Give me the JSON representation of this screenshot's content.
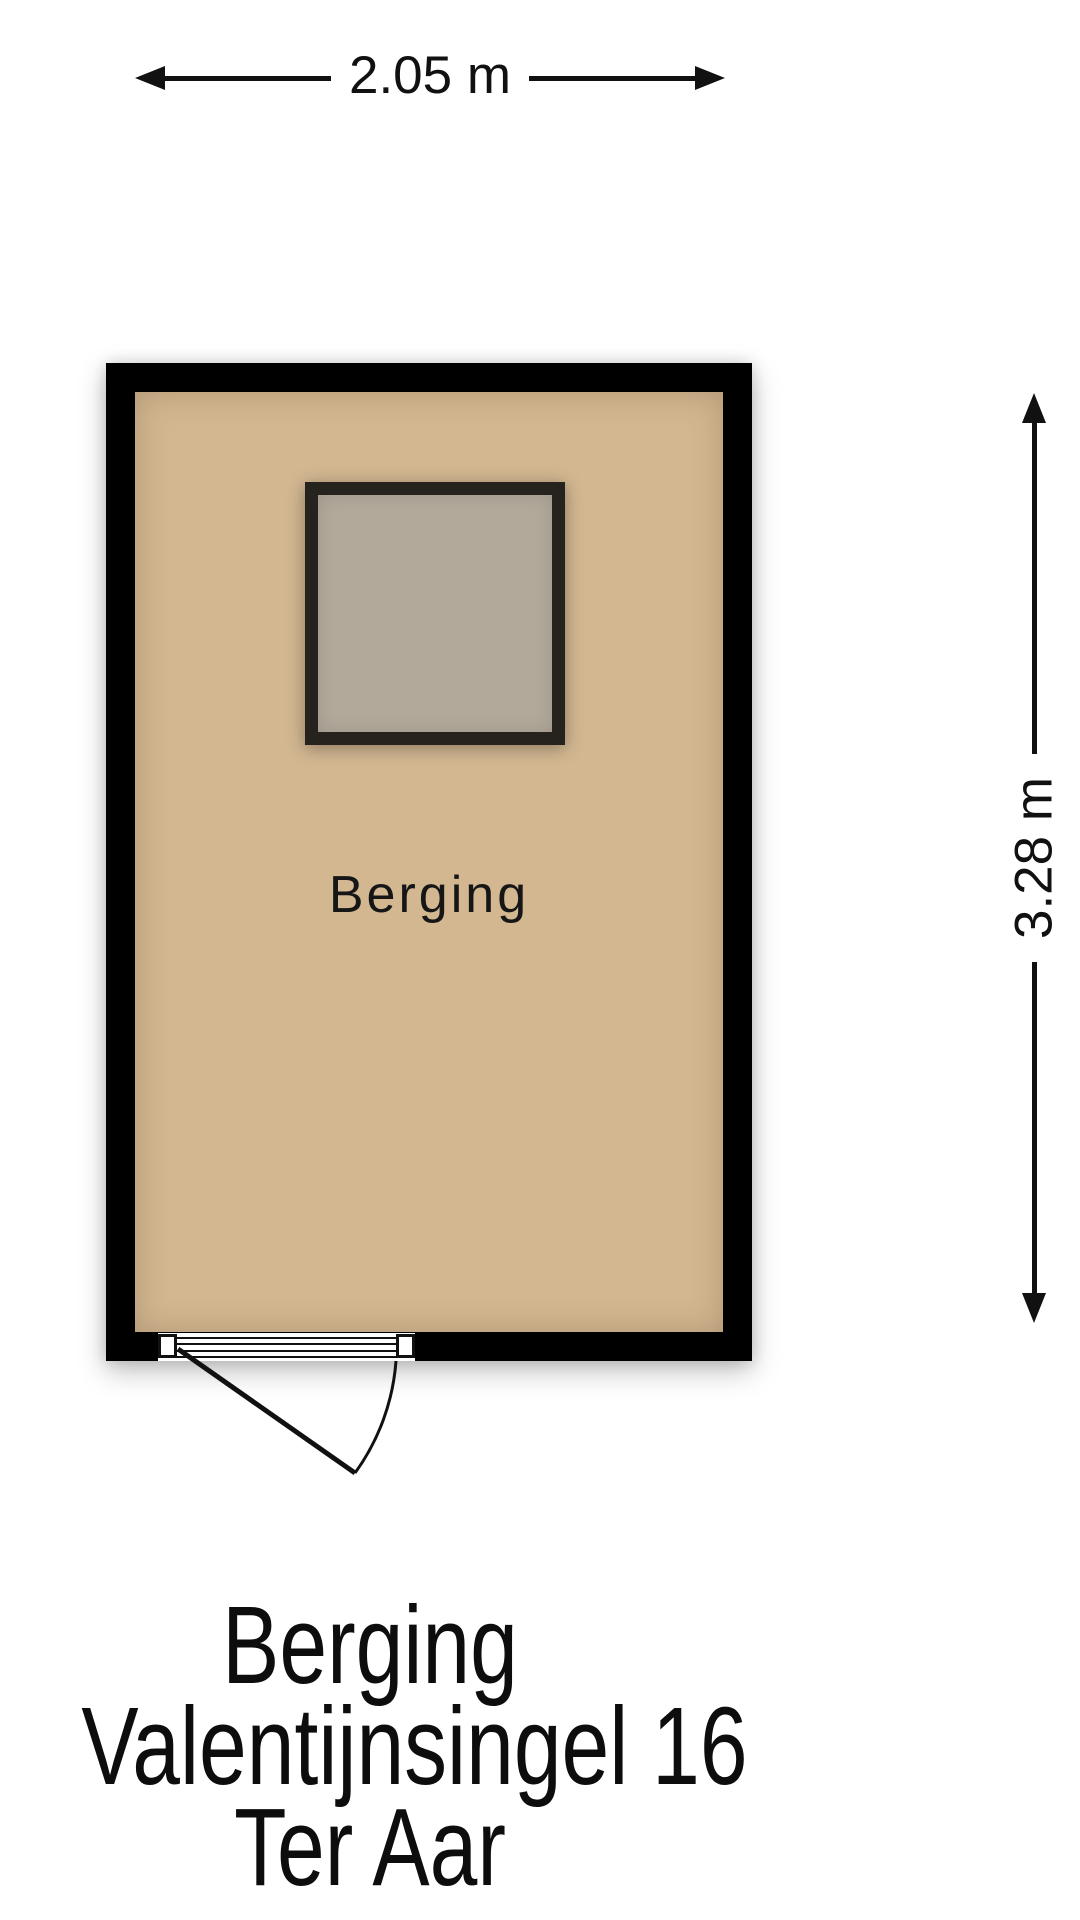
{
  "plan": {
    "type": "floor-plan",
    "room": {
      "label": "Berging",
      "colors": {
        "wall": "#000000",
        "floor": "#d2b791",
        "object_fill": "#b2a99b",
        "object_border": "#26231f"
      }
    },
    "dimensions": {
      "width": {
        "label": "2.05 m"
      },
      "height": {
        "label": "3.28 m"
      }
    },
    "footer": {
      "lines": [
        "Berging",
        "Valentijnsingel 16",
        "Ter Aar"
      ]
    },
    "line_color": "#111111",
    "background": "#ffffff"
  }
}
